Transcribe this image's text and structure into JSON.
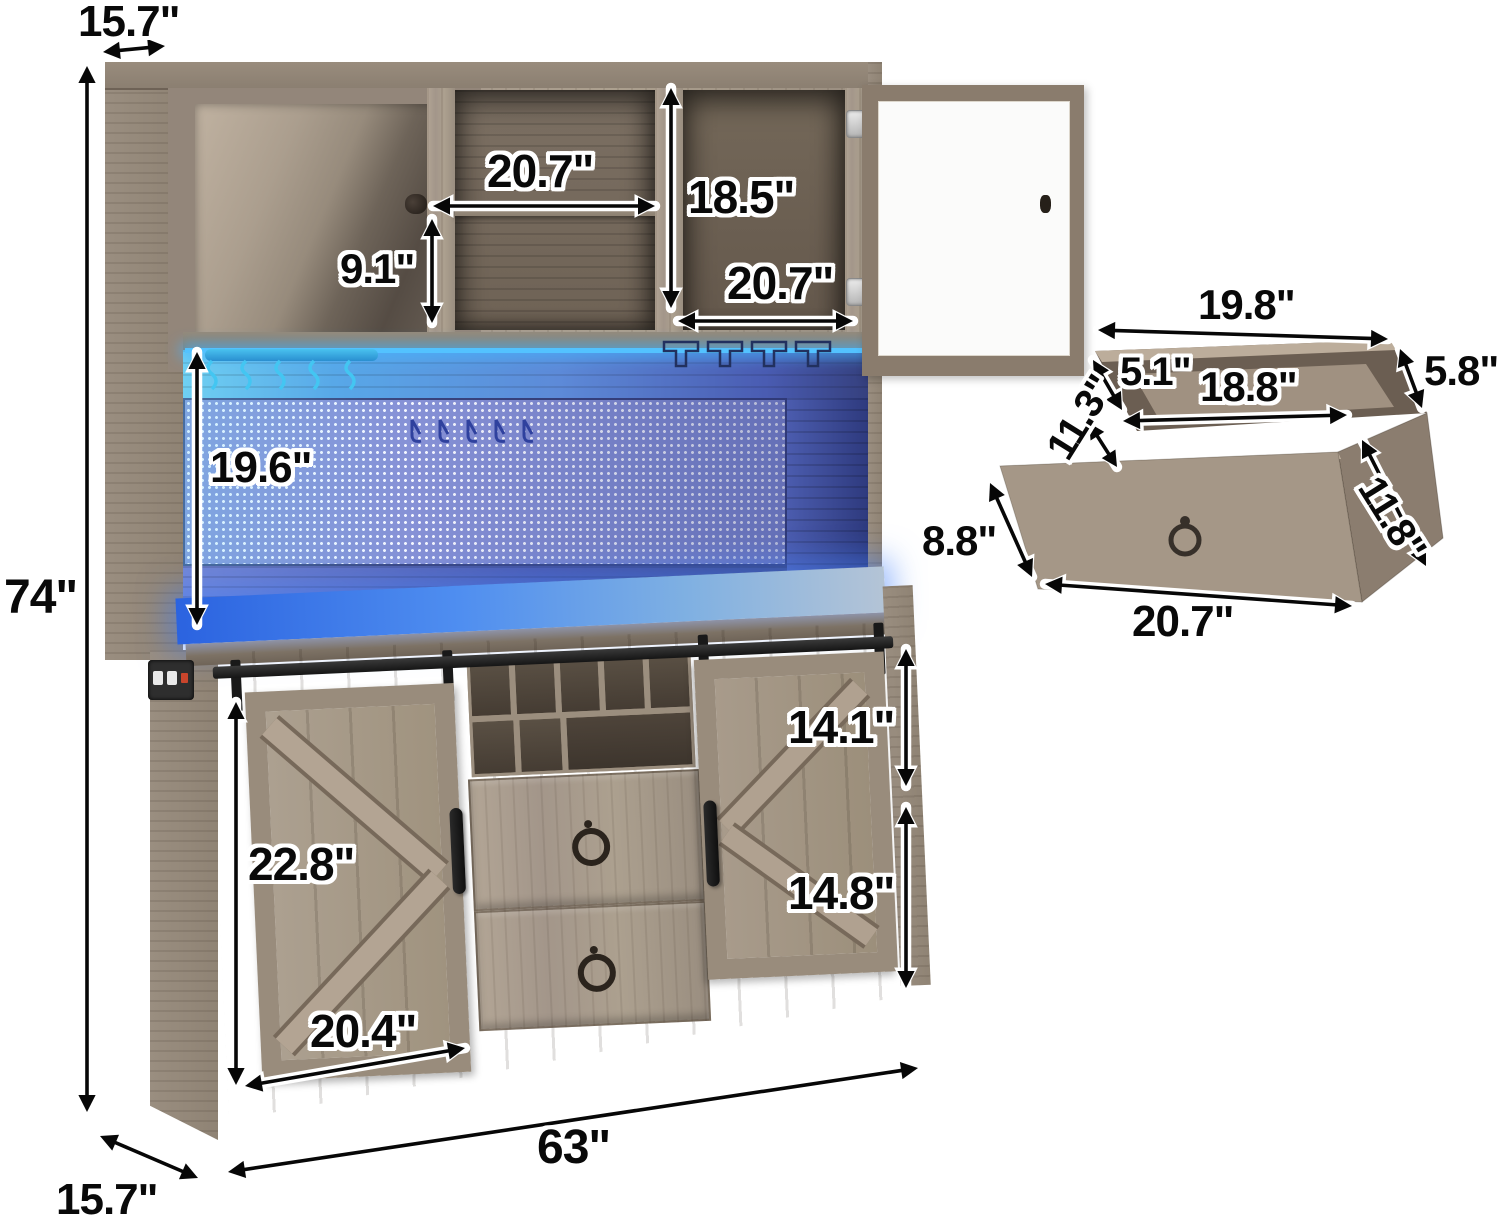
{
  "image_type": "product dimension diagram",
  "product": {
    "name": "Farmhouse bar cabinet with hutch, LED pegboard backsplash, sliding barn doors, wine rack and drawers",
    "views": {
      "main": "full cabinet front view",
      "inset": "pulled-out drawer detail"
    }
  },
  "dims": {
    "cabinet": {
      "top_depth": "15.7\"",
      "height": "74\"",
      "middle_shelf_width": "20.7\"",
      "upper_cabinet_height": "18.5\"",
      "middle_shelf_height": "9.1\"",
      "right_cabinet_width": "20.7\"",
      "hutch_opening_height": "19.6\"",
      "barn_door_height": "22.8\"",
      "barn_door_width": "20.4\"",
      "right_door_upper": "14.1\"",
      "right_door_lower": "14.8\"",
      "width": "63\"",
      "base_depth": "15.7\""
    },
    "drawer": {
      "top_width": "19.8\"",
      "side_height": "5.8\"",
      "inner_height": "5.1\"",
      "inner_width": "18.8\"",
      "inner_depth": "11.3\"",
      "front_height": "8.8\"",
      "side_depth": "11.8\"",
      "front_width": "20.7\""
    }
  },
  "colors": {
    "background": "#ffffff",
    "wood_light": "#a79a8b",
    "wood_dark": "#6f6357",
    "led_blue": "#2f6ae8",
    "led_cyan": "#57c8f5",
    "pegboard_blue": "#8b93d8",
    "hardware_black": "#1b1b1b",
    "glass_white": "#fbfbfa",
    "label_text": "#090909",
    "label_outline": "#ffffff"
  }
}
